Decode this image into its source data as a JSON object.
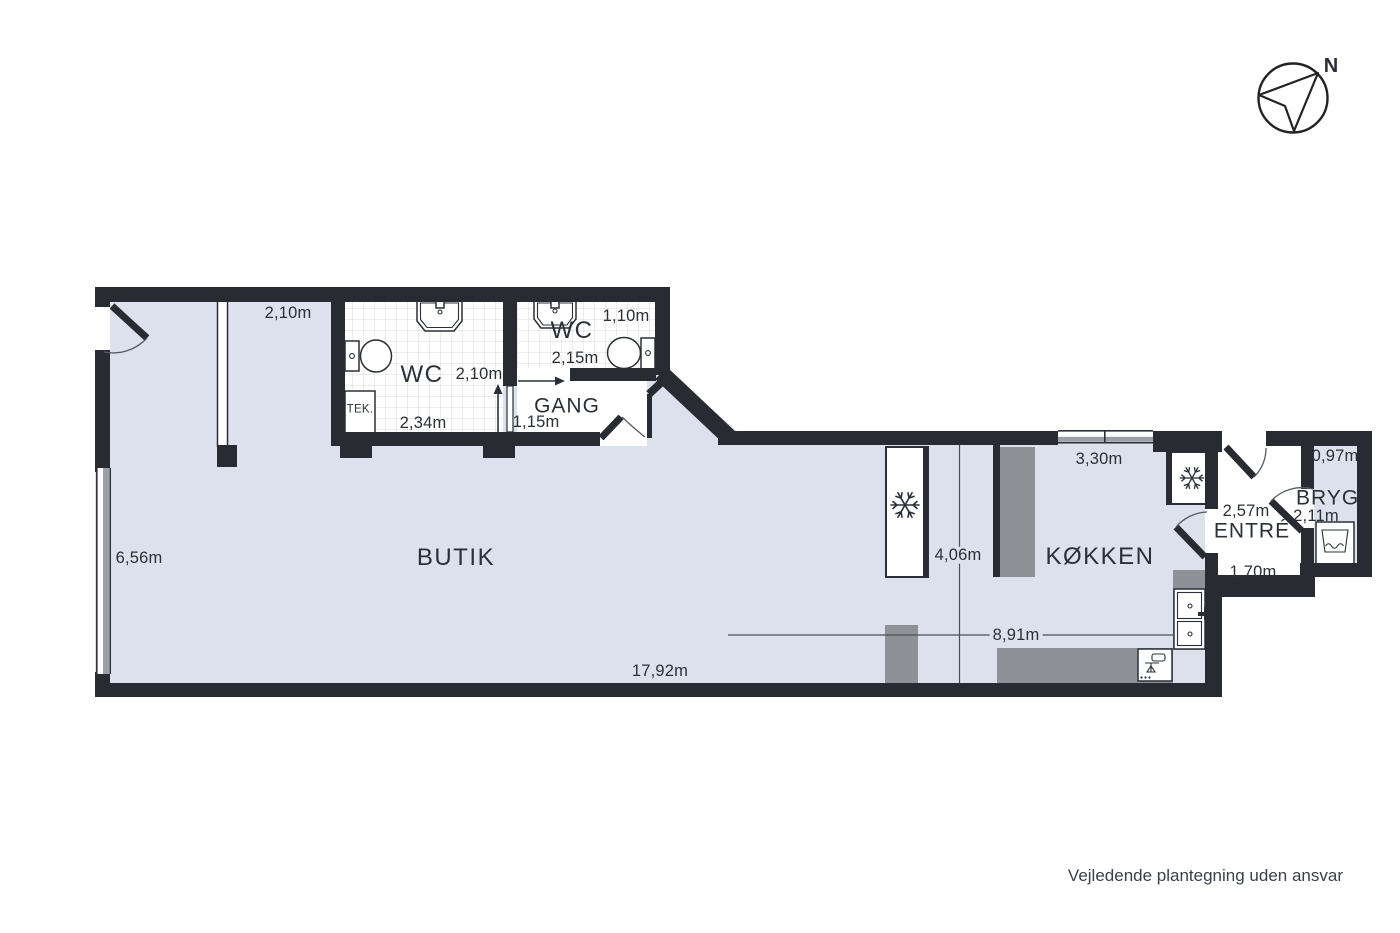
{
  "footer_note": "Vejledende plantegning uden ansvar",
  "compass": {
    "north_label": "N"
  },
  "rooms": {
    "butik": "BUTIK",
    "wc1": "WC",
    "wc2": "WC",
    "gang": "GANG",
    "kokken": "KØKKEN",
    "entre": "ENTRÉ",
    "bryg": "BRYG.",
    "tek": "TEK."
  },
  "dimensions": {
    "partition_top": "2,10m",
    "wc1_depth": "2,10m",
    "wc1_width": "2,34m",
    "wc2_door": "1,10m",
    "wc2_width": "2,15m",
    "gang_width": "1,15m",
    "left_wall": "6,56m",
    "total_width": "17,92m",
    "mid_width": "8,91m",
    "kitchen_depth": "4,06m",
    "kitchen_window": "3,30m",
    "entre_width": "2,57m",
    "entre_depth": "1,70m",
    "bryg_door": "0,97m",
    "bryg_width": "2,11m"
  },
  "icons": {
    "compass": "north-compass-arrow",
    "freezer": "snowflake",
    "fridge": "snowflake",
    "washer": "washing-machine-drum",
    "stove": "cooktop",
    "wc_sinks": "sink-basin",
    "wc_toilets": "toilet",
    "kitchen_sink": "double-sink"
  },
  "colors": {
    "wall": "#282b31",
    "floor": "#dce1ed",
    "gray": "#8e9196",
    "winband": "#9aa0a6",
    "ink": "#2b3038",
    "line": "#4a4f57",
    "tile": "#d9d9d9",
    "muted": "#3a4049"
  }
}
